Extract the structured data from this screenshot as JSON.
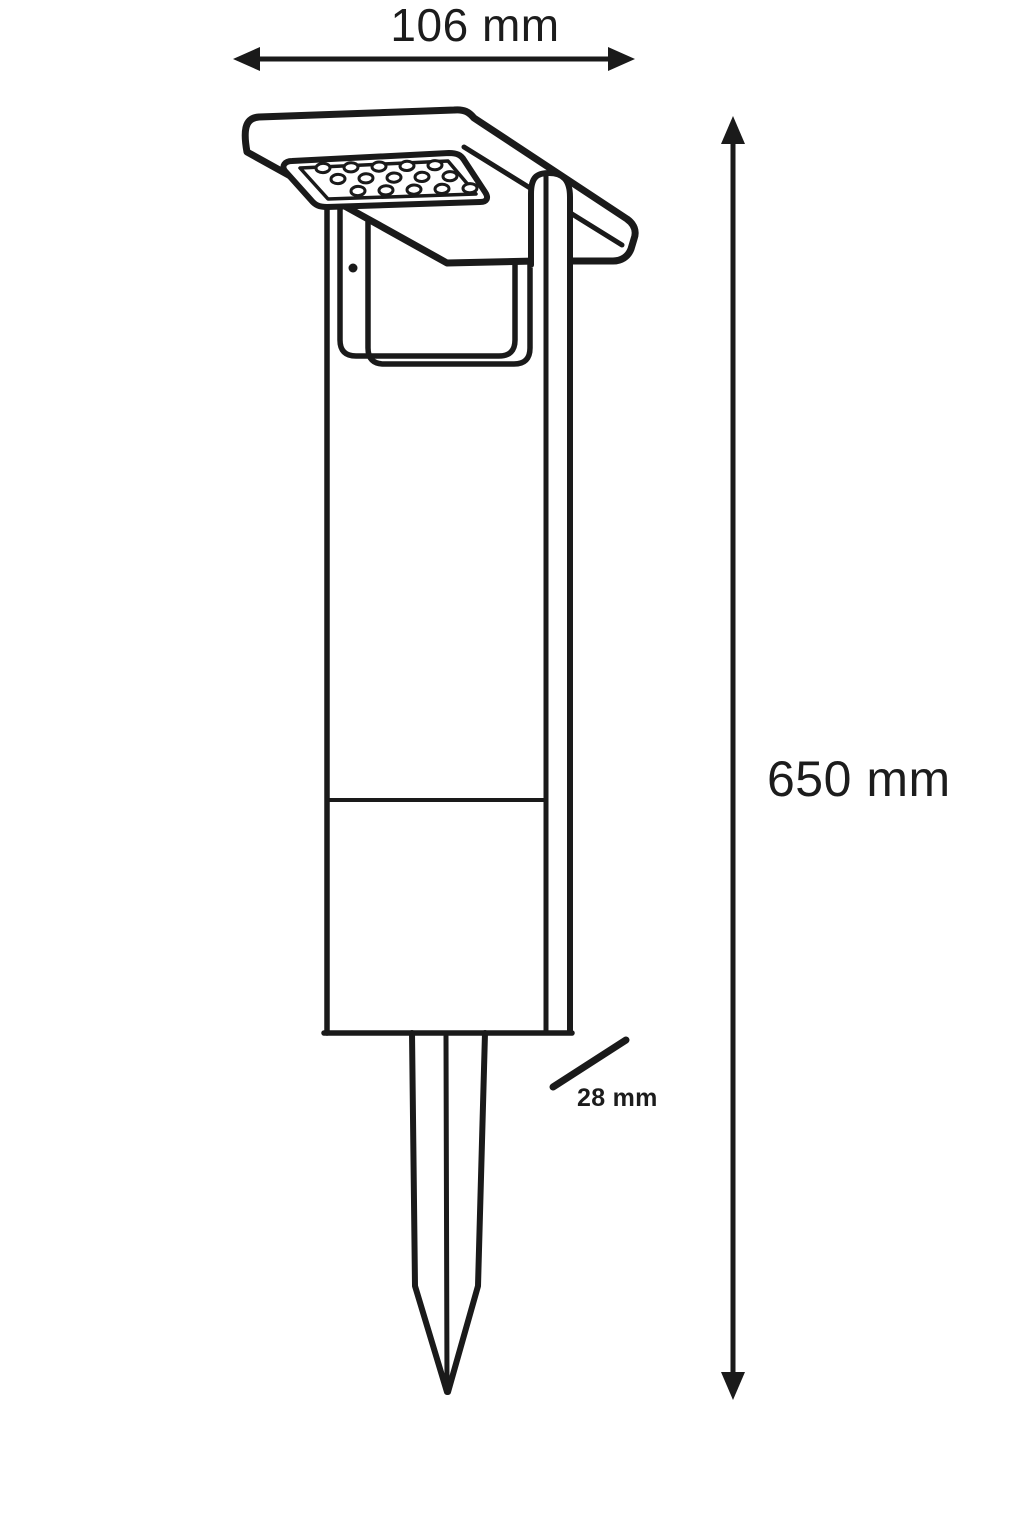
{
  "title": "Solar spike light dimensional drawing",
  "colors": {
    "line": "#1a1a1a",
    "background": "#ffffff"
  },
  "dimensions": {
    "width": {
      "label": "106 mm"
    },
    "height": {
      "label": "650 mm"
    },
    "spike": {
      "label": "28 mm"
    }
  },
  "illustration": {
    "led_grid": {
      "rows": 3,
      "cols": 5,
      "total_dots": 15
    }
  }
}
